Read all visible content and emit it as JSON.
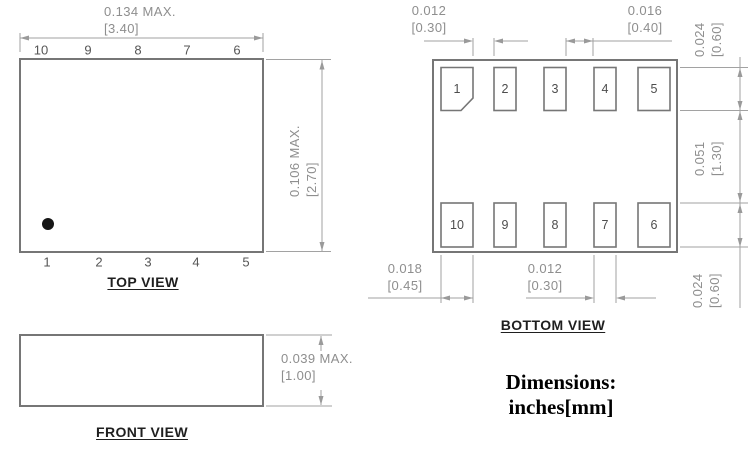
{
  "note": "Dimensions: inches[mm]",
  "colors": {
    "outline": "#767676",
    "dimension_lines": "#a2a2a2",
    "dimension_text": "#8e8e8e",
    "pin_text": "#4d4d4d",
    "title_text": "#1f1f1f",
    "pin1_dot": "#161616",
    "background": "#ffffff"
  },
  "top_view": {
    "title": "TOP VIEW",
    "pins_top": [
      "10",
      "9",
      "8",
      "7",
      "6"
    ],
    "pins_bottom": [
      "1",
      "2",
      "3",
      "4",
      "5"
    ],
    "dim_width": {
      "in": "0.134 MAX.",
      "mm": "[3.40]"
    },
    "dim_height": {
      "in": "0.106 MAX.",
      "mm": "[2.70]"
    }
  },
  "front_view": {
    "title": "FRONT VIEW",
    "dim_height": {
      "in": "0.039 MAX.",
      "mm": "[1.00]"
    }
  },
  "bottom_view": {
    "title": "BOTTOM VIEW",
    "pads_top": [
      "1",
      "2",
      "3",
      "4",
      "5"
    ],
    "pads_bottom": [
      "10",
      "9",
      "8",
      "7",
      "6"
    ],
    "dim_gap_pad1_pad2": {
      "in": "0.012",
      "mm": "[0.30]"
    },
    "dim_gap_pad3_pad4": {
      "in": "0.016",
      "mm": "[0.40]"
    },
    "dim_pad_height_top": {
      "in": "0.024",
      "mm": "[0.60]"
    },
    "dim_row_spacing": {
      "in": "0.051",
      "mm": "[1.30]"
    },
    "dim_pad_height_bottom": {
      "in": "0.024",
      "mm": "[0.60]"
    },
    "dim_corner_pad_width": {
      "in": "0.018",
      "mm": "[0.45]"
    },
    "dim_inner_pad_width": {
      "in": "0.012",
      "mm": "[0.30]"
    }
  }
}
